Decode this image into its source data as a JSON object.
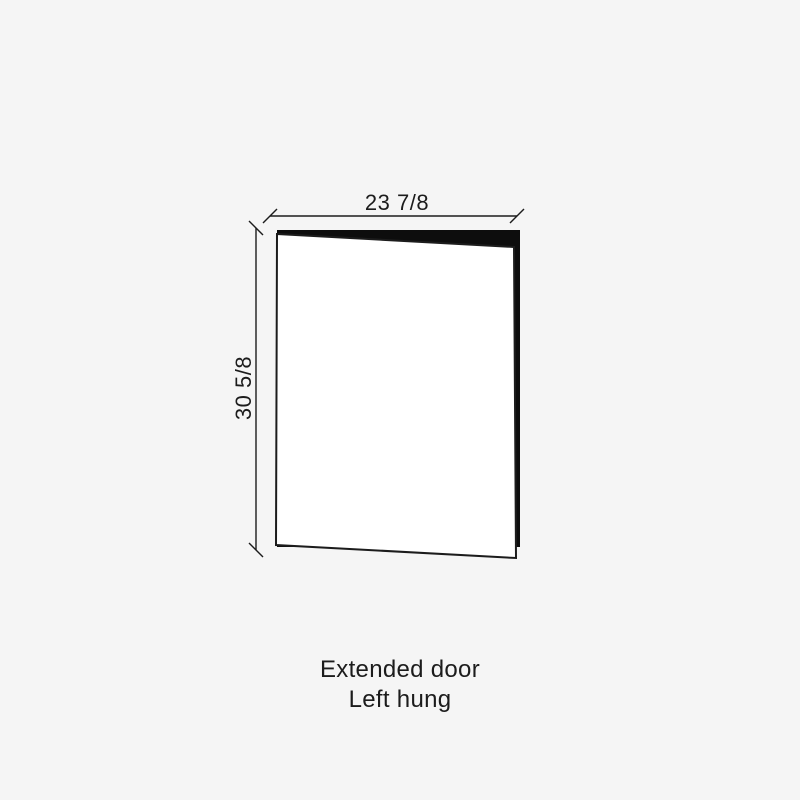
{
  "colors": {
    "background": "#f5f5f5",
    "line": "#1c1c1c",
    "door_edge_fill": "#0d0d0d",
    "door_face_fill": "#ffffff",
    "text": "#1c1c1c"
  },
  "diagram": {
    "width_dimension": "23 7/8",
    "height_dimension": "30 5/8"
  },
  "caption": {
    "line1": "Extended door",
    "line2": "Left hung"
  }
}
